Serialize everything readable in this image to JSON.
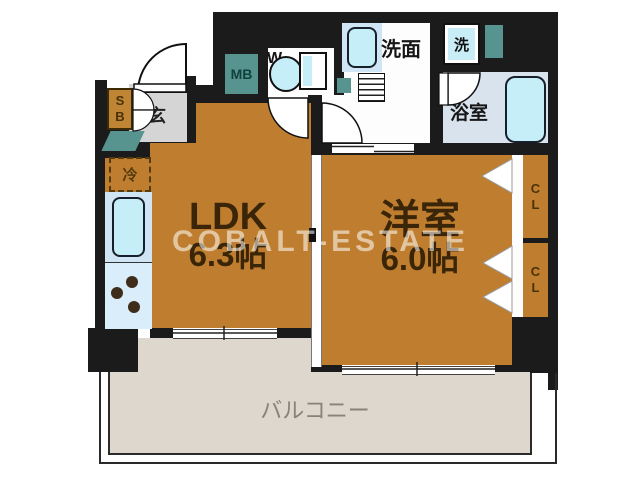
{
  "watermark": "COBALT-ESTATE",
  "rooms": {
    "ldk": {
      "label": "LDK",
      "size": "6.3帖"
    },
    "western": {
      "label": "洋室",
      "size": "6.0帖"
    },
    "balcony": {
      "label": "バルコニー"
    },
    "washroom": {
      "label": "洗面"
    },
    "bathroom": {
      "label": "浴室"
    },
    "entrance": {
      "label": "玄"
    },
    "toilet": {
      "label": "WC"
    },
    "washer": {
      "label": "洗"
    }
  },
  "fixtures": {
    "refrigerator": "冷",
    "meter_box": "MB",
    "shoe_box": "SB",
    "closet_top": "CL",
    "closet_bottom": "CL"
  },
  "colors": {
    "wall": "#1b1b1b",
    "room_floor": "#bf7e2f",
    "balcony_floor": "#ded7cd",
    "bathroom_floor": "#d9e3ee",
    "fixture_cyan": "#c5eef8",
    "utility_teal": "#57948f",
    "entrance_gray": "#d5d5d5",
    "label_brown": "#3a2508",
    "balcony_text": "#8b8277"
  }
}
